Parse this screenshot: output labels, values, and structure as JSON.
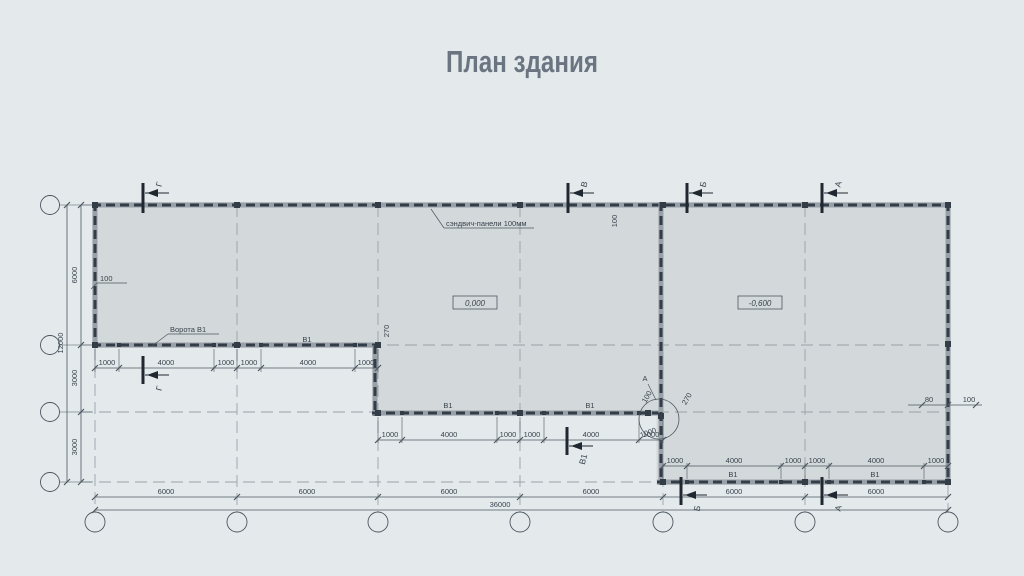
{
  "title": "План здания",
  "colors": {
    "background": "#e4eaec",
    "building_fill": "#d3d8da",
    "wall_band": "#99a1a8",
    "wall_dash": "#333d47",
    "line": "#4d5761",
    "axis_dash": "#9aa2a8",
    "text": "#39434d",
    "title_text": "#6b7582"
  },
  "plan": {
    "axes_columns": [
      {
        "label": "1",
        "x": 95
      },
      {
        "label": "2",
        "x": 237
      },
      {
        "label": "3",
        "x": 378
      },
      {
        "label": "4",
        "x": 520
      },
      {
        "label": "5",
        "x": 663
      },
      {
        "label": "6",
        "x": 805
      },
      {
        "label": "7",
        "x": 948
      }
    ],
    "axes_rows": [
      {
        "label": "Г",
        "y": 205
      },
      {
        "label": "В",
        "y": 345
      },
      {
        "label": "Б",
        "y": 412
      },
      {
        "label": "А",
        "y": 482
      }
    ],
    "circle_row_cx": 50,
    "circle_col_cy": 522,
    "outline": "92,202 951,202 951,485 656.5,485 656.5,416 372,416 372,348 92,348",
    "axis_dashes_v": [
      {
        "x": 95,
        "y1": 348,
        "y2": 512
      },
      {
        "x": 237,
        "y1": 205,
        "y2": 512
      },
      {
        "x": 378,
        "y1": 205,
        "y2": 512
      },
      {
        "x": 520,
        "y1": 205,
        "y2": 512
      },
      {
        "x": 663,
        "y1": 205,
        "y2": 512
      },
      {
        "x": 805,
        "y1": 205,
        "y2": 512
      },
      {
        "x": 948,
        "y1": 485,
        "y2": 512
      }
    ],
    "axis_dashes_h": [
      {
        "y": 205,
        "x1": 81,
        "x2": 948
      },
      {
        "y": 345,
        "x1": 81,
        "x2": 948
      },
      {
        "y": 412,
        "x1": 81,
        "x2": 948
      },
      {
        "y": 482,
        "x1": 81,
        "x2": 948
      }
    ],
    "walls": [
      {
        "name": "wall-top",
        "x1": 92,
        "y1": 205,
        "x2": 951,
        "y2": 205
      },
      {
        "name": "wall-left",
        "x1": 95,
        "y1": 202,
        "x2": 95,
        "y2": 348
      },
      {
        "name": "wall-axis-v",
        "x1": 92,
        "y1": 345,
        "x2": 380,
        "y2": 345
      },
      {
        "name": "wall-step-left",
        "x1": 375,
        "y1": 345,
        "x2": 375,
        "y2": 416
      },
      {
        "name": "wall-mid-bottom",
        "x1": 372,
        "y1": 413,
        "x2": 661,
        "y2": 413
      },
      {
        "name": "wall-axis-5",
        "x1": 661,
        "y1": 202,
        "x2": 661,
        "y2": 485
      },
      {
        "name": "wall-right-bottom",
        "x1": 657,
        "y1": 482,
        "x2": 951,
        "y2": 482
      },
      {
        "name": "wall-right",
        "x1": 948,
        "y1": 202,
        "x2": 948,
        "y2": 485
      }
    ],
    "columns": [
      [
        95,
        205
      ],
      [
        237,
        205
      ],
      [
        378,
        205
      ],
      [
        520,
        205
      ],
      [
        663,
        205
      ],
      [
        805,
        205
      ],
      [
        948,
        205
      ],
      [
        95,
        345
      ],
      [
        237,
        345
      ],
      [
        378,
        345
      ],
      [
        378,
        413
      ],
      [
        520,
        413
      ],
      [
        648,
        413
      ],
      [
        661,
        416
      ],
      [
        663,
        482
      ],
      [
        805,
        482
      ],
      [
        948,
        482
      ],
      [
        948,
        344
      ]
    ],
    "posts": [
      [
        119,
        345
      ],
      [
        214,
        345
      ],
      [
        261,
        345
      ],
      [
        355,
        345
      ],
      [
        402,
        413
      ],
      [
        497,
        413
      ],
      [
        544,
        413
      ],
      [
        639,
        413
      ],
      [
        687,
        482
      ],
      [
        781,
        482
      ],
      [
        829,
        482
      ],
      [
        924,
        482
      ]
    ],
    "dim_lines": [
      {
        "name": "dims-gates-left",
        "x1": 95,
        "y": 368,
        "x2": 378,
        "ticks": [
          95,
          119,
          214,
          237,
          261,
          355,
          378
        ],
        "ext": [
          349,
          372
        ]
      },
      {
        "name": "dims-gates-middle",
        "x1": 378,
        "y": 440,
        "x2": 663,
        "ticks": [
          378,
          402,
          497,
          520,
          544,
          639,
          663
        ],
        "ext": [
          417,
          443
        ]
      },
      {
        "name": "dims-gates-right",
        "x1": 663,
        "y": 466,
        "x2": 948,
        "ticks": [
          663,
          687,
          781,
          805,
          829,
          924,
          948
        ],
        "ext": [
          463,
          479
        ]
      },
      {
        "name": "dims-bays-6000",
        "x1": 95,
        "y": 497,
        "x2": 948,
        "ticks": [
          95,
          237,
          378,
          520,
          663,
          805,
          948
        ]
      },
      {
        "name": "dims-total-36000",
        "x1": 95,
        "y": 510,
        "x2": 948,
        "ticks": [
          95,
          948
        ]
      },
      {
        "name": "dims-wall-offset-right",
        "x1": 908,
        "y": 405,
        "x2": 982,
        "ticks": [
          922,
          948,
          976
        ]
      }
    ],
    "dim_lines_v": [
      {
        "name": "dims-rows-left",
        "x": 81,
        "y1": 205,
        "y2": 482,
        "ticks": [
          205,
          345,
          412,
          482
        ]
      },
      {
        "name": "dims-total-12000",
        "x": 67,
        "y1": 205,
        "y2": 482,
        "ticks": [
          205,
          482
        ]
      }
    ],
    "dim_texts": [
      {
        "t": "1000",
        "x": 107,
        "y": 365
      },
      {
        "t": "4000",
        "x": 166,
        "y": 365
      },
      {
        "t": "1000",
        "x": 226,
        "y": 365
      },
      {
        "t": "1000",
        "x": 249,
        "y": 365
      },
      {
        "t": "4000",
        "x": 308,
        "y": 365
      },
      {
        "t": "1000",
        "x": 366,
        "y": 365
      },
      {
        "t": "1000",
        "x": 390,
        "y": 437
      },
      {
        "t": "4000",
        "x": 449,
        "y": 437
      },
      {
        "t": "1000",
        "x": 508,
        "y": 437
      },
      {
        "t": "1000",
        "x": 532,
        "y": 437
      },
      {
        "t": "4000",
        "x": 591,
        "y": 437
      },
      {
        "t": "1000",
        "x": 651,
        "y": 437
      },
      {
        "t": "1000",
        "x": 675,
        "y": 463
      },
      {
        "t": "4000",
        "x": 734,
        "y": 463
      },
      {
        "t": "1000",
        "x": 793,
        "y": 463
      },
      {
        "t": "1000",
        "x": 817,
        "y": 463
      },
      {
        "t": "4000",
        "x": 876,
        "y": 463
      },
      {
        "t": "1000",
        "x": 936,
        "y": 463
      },
      {
        "t": "6000",
        "x": 166,
        "y": 494
      },
      {
        "t": "6000",
        "x": 307,
        "y": 494
      },
      {
        "t": "6000",
        "x": 449,
        "y": 494
      },
      {
        "t": "6000",
        "x": 591,
        "y": 494
      },
      {
        "t": "6000",
        "x": 734,
        "y": 494
      },
      {
        "t": "6000",
        "x": 876,
        "y": 494
      },
      {
        "t": "36000",
        "x": 500,
        "y": 507
      },
      {
        "t": "6000",
        "x": 77,
        "y": 275,
        "r": -90
      },
      {
        "t": "3000",
        "x": 77,
        "y": 378,
        "r": -90
      },
      {
        "t": "3000",
        "x": 77,
        "y": 447,
        "r": -90
      },
      {
        "t": "12000",
        "x": 63,
        "y": 343,
        "r": -90
      },
      {
        "t": "270",
        "x": 389,
        "y": 331,
        "r": -90
      },
      {
        "t": "100",
        "x": 617,
        "y": 221,
        "r": -90
      },
      {
        "t": "100",
        "x": 649,
        "y": 398,
        "r": -60
      },
      {
        "t": "270",
        "x": 689,
        "y": 400,
        "r": -60
      },
      {
        "t": "1000",
        "x": 649,
        "y": 435,
        "r": -20
      },
      {
        "t": "80",
        "x": 929,
        "y": 402
      },
      {
        "t": "100",
        "x": 969,
        "y": 402
      }
    ],
    "free_labels": [
      {
        "t": "В1",
        "x": 307,
        "y": 342
      },
      {
        "t": "В1",
        "x": 448,
        "y": 408
      },
      {
        "t": "В1",
        "x": 590,
        "y": 408
      },
      {
        "t": "В1",
        "x": 733,
        "y": 477
      },
      {
        "t": "В1",
        "x": 875,
        "y": 477
      },
      {
        "t": "А",
        "x": 645,
        "y": 381
      }
    ],
    "leader_labels": [
      {
        "t": "сэндвич-панели 100мм",
        "x": 446,
        "y": 226,
        "ux1": 444,
        "ux2": 534,
        "uy": 228,
        "lx": 431,
        "ly": 209
      },
      {
        "t": "100",
        "x": 100,
        "y": 281,
        "ux1": 97,
        "ux2": 127,
        "uy": 283,
        "lx": 91,
        "ly": 289
      },
      {
        "t": "Ворота В1",
        "x": 170,
        "y": 332,
        "ux1": 168,
        "ux2": 219,
        "uy": 334,
        "lx": 152,
        "ly": 346
      }
    ],
    "elevation_marks": [
      {
        "t": "0,000",
        "x": 475,
        "y": 303
      },
      {
        "t": "-0,600",
        "x": 760,
        "y": 303
      }
    ],
    "section_marks_top": [
      {
        "l": "Г",
        "x": 143,
        "y1": 183,
        "y2": 213,
        "hy": 193
      },
      {
        "l": "В",
        "x": 568,
        "y1": 183,
        "y2": 213,
        "hy": 193
      },
      {
        "l": "Б",
        "x": 687,
        "y1": 183,
        "y2": 213,
        "hy": 193
      },
      {
        "l": "А",
        "x": 822,
        "y1": 183,
        "y2": 213,
        "hy": 193
      }
    ],
    "section_marks_bottom": [
      {
        "l": "Г",
        "x": 143,
        "y1": 356,
        "y2": 384,
        "hy": 375
      },
      {
        "l": "В1",
        "x": 567,
        "y1": 427,
        "y2": 455,
        "hy": 446
      },
      {
        "l": "Б",
        "x": 681,
        "y1": 477,
        "y2": 505,
        "hy": 495
      },
      {
        "l": "А",
        "x": 822,
        "y1": 477,
        "y2": 505,
        "hy": 495
      }
    ],
    "detail_circle": {
      "label": "А",
      "cx": 659,
      "cy": 419,
      "r": 20,
      "leader": [
        648,
        384,
        656,
        400
      ]
    }
  }
}
